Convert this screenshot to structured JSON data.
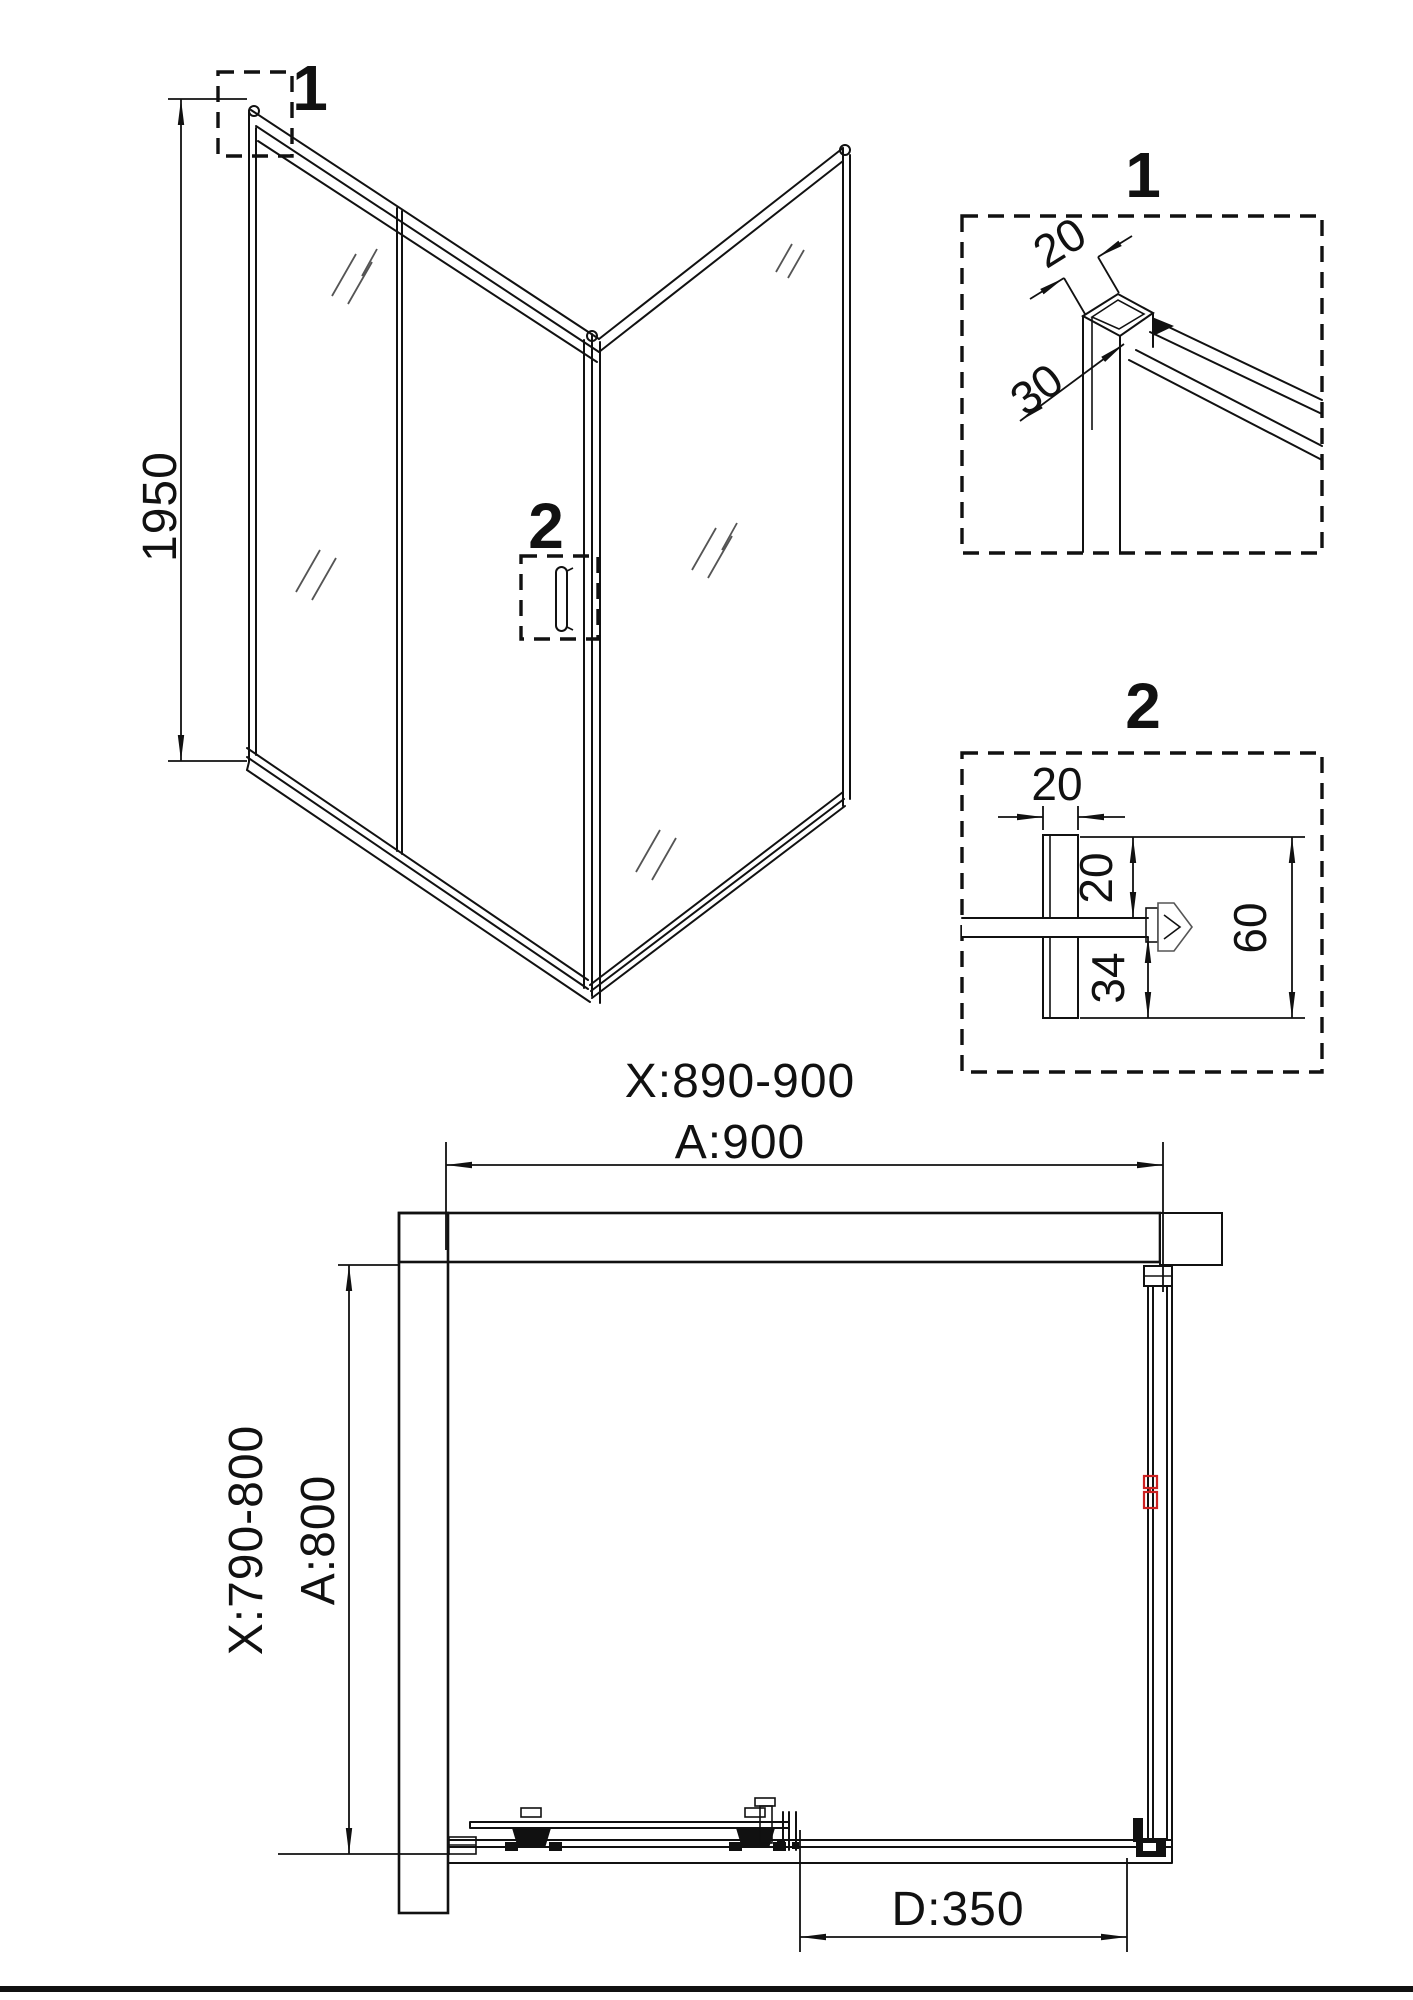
{
  "perspective": {
    "height_dim": "1950",
    "callout1": "1",
    "callout2": "2"
  },
  "detail1": {
    "label": "1",
    "dim_width": "20",
    "dim_depth": "30"
  },
  "detail2": {
    "label": "2",
    "dim_profile_width": "20",
    "dim_top_inset": "20",
    "dim_bottom_inset": "34",
    "dim_total_depth": "60"
  },
  "plan": {
    "width_adjust_range": "X:890-900",
    "width_nominal": "A:900",
    "depth_adjust_range": "X:790-800",
    "depth_nominal": "A:800",
    "door_dim": "D:350"
  },
  "colors": {
    "line": "#111111",
    "accent_red": "#cc2222",
    "background": "#ffffff"
  }
}
